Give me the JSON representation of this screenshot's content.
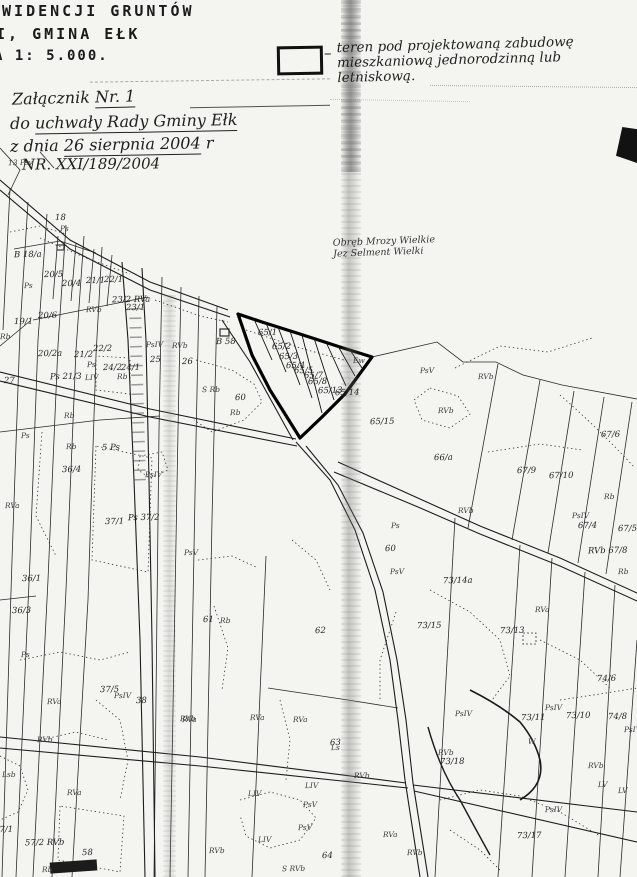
{
  "document": {
    "type": "scanned cadastral map attachment",
    "header": {
      "line1": "EWIDENCJI GRUNTÓW",
      "line2": "I, GMINA EŁK",
      "line3": "A 1: 5.000."
    },
    "handwritten": {
      "attachment_prefix": "Załącznik",
      "attachment_no": "Nr. 1",
      "resolution_prefix": "do",
      "resolution": "uchwały Rady Gminy Ełk",
      "date_prefix": "z dnia",
      "date": "26 sierpnia 2004",
      "date_suffix": "r",
      "number": "NR. XXI/189/2004"
    },
    "legend": {
      "symbol": "rectangle-outline",
      "dash": "–",
      "line1": "teren pod projektowaną zabudowę",
      "line2": "mieszkaniową jednorodzinną lub",
      "line3": "letniskową."
    }
  },
  "map": {
    "region_line1": "Obręb Mrozy Wielkie",
    "region_line2": "Jez Selment Wielki",
    "highlighted_parcels": [
      "65/1",
      "65/2",
      "65/3",
      "65/4",
      "65/5",
      "65/7",
      "65/8",
      "65/13",
      "65/14"
    ],
    "colors": {
      "ink": "#1c1c1c",
      "paper": "#f4f4f0",
      "highlight_stroke": "#000000"
    },
    "labels": [
      {
        "t": "13 Psv",
        "x": 8,
        "y": 158,
        "k": "cls"
      },
      {
        "t": "18",
        "x": 55,
        "y": 213,
        "k": "num"
      },
      {
        "t": "Ps",
        "x": 60,
        "y": 224,
        "k": "cls"
      },
      {
        "t": "B 18/a",
        "x": 14,
        "y": 250,
        "k": "num"
      },
      {
        "t": "Ps",
        "x": 24,
        "y": 281,
        "k": "cls"
      },
      {
        "t": "20/5",
        "x": 44,
        "y": 270,
        "k": "num"
      },
      {
        "t": "20/4",
        "x": 62,
        "y": 279,
        "k": "num"
      },
      {
        "t": "21/1",
        "x": 86,
        "y": 276,
        "k": "num"
      },
      {
        "t": "22/1",
        "x": 104,
        "y": 275,
        "k": "num"
      },
      {
        "t": "23/2 RVa",
        "x": 112,
        "y": 295,
        "k": "num"
      },
      {
        "t": "23/1",
        "x": 126,
        "y": 303,
        "k": "num"
      },
      {
        "t": "RVb",
        "x": 86,
        "y": 305,
        "k": "cls"
      },
      {
        "t": "20/6",
        "x": 38,
        "y": 311,
        "k": "num"
      },
      {
        "t": "19/1",
        "x": 14,
        "y": 317,
        "k": "num"
      },
      {
        "t": "Rb",
        "x": 0,
        "y": 332,
        "k": "cls"
      },
      {
        "t": "20/2a",
        "x": 38,
        "y": 349,
        "k": "num"
      },
      {
        "t": "21/2",
        "x": 74,
        "y": 350,
        "k": "num"
      },
      {
        "t": "22/2",
        "x": 93,
        "y": 344,
        "k": "num"
      },
      {
        "t": "Ps",
        "x": 87,
        "y": 360,
        "k": "cls"
      },
      {
        "t": "24/2",
        "x": 103,
        "y": 363,
        "k": "num"
      },
      {
        "t": "24/1",
        "x": 121,
        "y": 363,
        "k": "num"
      },
      {
        "t": "LIV",
        "x": 85,
        "y": 373,
        "k": "cls"
      },
      {
        "t": "Rb",
        "x": 117,
        "y": 372,
        "k": "cls"
      },
      {
        "t": "PsIV",
        "x": 146,
        "y": 340,
        "k": "cls"
      },
      {
        "t": "RVb",
        "x": 172,
        "y": 341,
        "k": "cls"
      },
      {
        "t": "25",
        "x": 150,
        "y": 355,
        "k": "num"
      },
      {
        "t": "26",
        "x": 182,
        "y": 357,
        "k": "num"
      },
      {
        "t": "27",
        "x": 4,
        "y": 376,
        "k": "num"
      },
      {
        "t": "Ps 21/3",
        "x": 50,
        "y": 372,
        "k": "num"
      },
      {
        "t": "Rb",
        "x": 64,
        "y": 411,
        "k": "cls"
      },
      {
        "t": "B 58",
        "x": 216,
        "y": 337,
        "k": "num"
      },
      {
        "t": "S Rb",
        "x": 202,
        "y": 385,
        "k": "cls"
      },
      {
        "t": "60",
        "x": 235,
        "y": 393,
        "k": "num"
      },
      {
        "t": "Rb",
        "x": 230,
        "y": 408,
        "k": "cls"
      },
      {
        "t": "65/1",
        "x": 258,
        "y": 328,
        "k": "num"
      },
      {
        "t": "65/2",
        "x": 272,
        "y": 342,
        "k": "num"
      },
      {
        "t": "65/3",
        "x": 279,
        "y": 352,
        "k": "num"
      },
      {
        "t": "65/4",
        "x": 286,
        "y": 361,
        "k": "num"
      },
      {
        "t": "65/5",
        "x": 294,
        "y": 366,
        "k": "num"
      },
      {
        "t": "65/7",
        "x": 304,
        "y": 371,
        "k": "num"
      },
      {
        "t": "65/8",
        "x": 308,
        "y": 377,
        "k": "num"
      },
      {
        "t": "65/13",
        "x": 318,
        "y": 386,
        "k": "num"
      },
      {
        "t": "65/14",
        "x": 335,
        "y": 388,
        "k": "num"
      },
      {
        "t": "Ew",
        "x": 353,
        "y": 356,
        "k": "cls"
      },
      {
        "t": "PsV",
        "x": 420,
        "y": 366,
        "k": "cls"
      },
      {
        "t": "RVb",
        "x": 478,
        "y": 372,
        "k": "cls"
      },
      {
        "t": "RVb",
        "x": 438,
        "y": 406,
        "k": "cls"
      },
      {
        "t": "65/15",
        "x": 370,
        "y": 417,
        "k": "num"
      },
      {
        "t": "66/a",
        "x": 434,
        "y": 453,
        "k": "num"
      },
      {
        "t": "67/9",
        "x": 517,
        "y": 466,
        "k": "num"
      },
      {
        "t": "67/10",
        "x": 549,
        "y": 471,
        "k": "num"
      },
      {
        "t": "67/6",
        "x": 601,
        "y": 430,
        "k": "num"
      },
      {
        "t": "Rb",
        "x": 604,
        "y": 492,
        "k": "cls"
      },
      {
        "t": "PsIV",
        "x": 572,
        "y": 511,
        "k": "cls"
      },
      {
        "t": "67/4",
        "x": 578,
        "y": 521,
        "k": "num"
      },
      {
        "t": "67/5",
        "x": 618,
        "y": 524,
        "k": "num"
      },
      {
        "t": "RVb 67/8",
        "x": 588,
        "y": 546,
        "k": "num"
      },
      {
        "t": "Rb",
        "x": 618,
        "y": 567,
        "k": "cls"
      },
      {
        "t": "RVb",
        "x": 458,
        "y": 506,
        "k": "cls"
      },
      {
        "t": "Ps",
        "x": 391,
        "y": 521,
        "k": "cls"
      },
      {
        "t": "60",
        "x": 385,
        "y": 544,
        "k": "num"
      },
      {
        "t": "PsV",
        "x": 390,
        "y": 567,
        "k": "cls"
      },
      {
        "t": "73/14a",
        "x": 443,
        "y": 576,
        "k": "num"
      },
      {
        "t": "RVa",
        "x": 535,
        "y": 605,
        "k": "cls"
      },
      {
        "t": "73/13",
        "x": 500,
        "y": 626,
        "k": "num"
      },
      {
        "t": "74/6",
        "x": 597,
        "y": 674,
        "k": "num"
      },
      {
        "t": "73/11",
        "x": 521,
        "y": 713,
        "k": "num"
      },
      {
        "t": "PsIV",
        "x": 545,
        "y": 703,
        "k": "cls"
      },
      {
        "t": "73/10",
        "x": 566,
        "y": 711,
        "k": "num"
      },
      {
        "t": "74/8",
        "x": 608,
        "y": 712,
        "k": "num"
      },
      {
        "t": "PsIV",
        "x": 624,
        "y": 725,
        "k": "cls"
      },
      {
        "t": "PsIV",
        "x": 455,
        "y": 709,
        "k": "cls"
      },
      {
        "t": "W",
        "x": 528,
        "y": 737,
        "k": "cls"
      },
      {
        "t": "RVb",
        "x": 438,
        "y": 748,
        "k": "cls"
      },
      {
        "t": "73/18",
        "x": 440,
        "y": 757,
        "k": "num"
      },
      {
        "t": "RVb",
        "x": 588,
        "y": 761,
        "k": "cls"
      },
      {
        "t": "LV",
        "x": 598,
        "y": 780,
        "k": "cls"
      },
      {
        "t": "LV",
        "x": 618,
        "y": 786,
        "k": "cls"
      },
      {
        "t": "PsIV",
        "x": 545,
        "y": 805,
        "k": "cls"
      },
      {
        "t": "73/17",
        "x": 517,
        "y": 831,
        "k": "num"
      },
      {
        "t": "73/15",
        "x": 417,
        "y": 621,
        "k": "num"
      },
      {
        "t": "61",
        "x": 203,
        "y": 615,
        "k": "num"
      },
      {
        "t": "Rb",
        "x": 220,
        "y": 616,
        "k": "cls"
      },
      {
        "t": "62",
        "x": 315,
        "y": 626,
        "k": "num"
      },
      {
        "t": "RVa",
        "x": 182,
        "y": 715,
        "k": "cls"
      },
      {
        "t": "RVa",
        "x": 250,
        "y": 713,
        "k": "cls"
      },
      {
        "t": "RVa",
        "x": 293,
        "y": 715,
        "k": "cls"
      },
      {
        "t": "63",
        "x": 330,
        "y": 738,
        "k": "num"
      },
      {
        "t": "RVb",
        "x": 354,
        "y": 771,
        "k": "cls"
      },
      {
        "t": "Ls",
        "x": 331,
        "y": 743,
        "k": "cls"
      },
      {
        "t": "LIV",
        "x": 305,
        "y": 781,
        "k": "cls"
      },
      {
        "t": "LIV",
        "x": 248,
        "y": 789,
        "k": "cls"
      },
      {
        "t": "PsV",
        "x": 303,
        "y": 800,
        "k": "cls"
      },
      {
        "t": "PsV",
        "x": 298,
        "y": 823,
        "k": "cls"
      },
      {
        "t": "LIV",
        "x": 258,
        "y": 835,
        "k": "cls"
      },
      {
        "t": "RVb",
        "x": 209,
        "y": 846,
        "k": "cls"
      },
      {
        "t": "64",
        "x": 322,
        "y": 851,
        "k": "num"
      },
      {
        "t": "S RVb",
        "x": 282,
        "y": 864,
        "k": "cls"
      },
      {
        "t": "RVa",
        "x": 383,
        "y": 830,
        "k": "cls"
      },
      {
        "t": "RVb",
        "x": 407,
        "y": 848,
        "k": "cls"
      },
      {
        "t": "Ps",
        "x": 21,
        "y": 650,
        "k": "cls"
      },
      {
        "t": "RVa",
        "x": 47,
        "y": 697,
        "k": "cls"
      },
      {
        "t": "37/5",
        "x": 100,
        "y": 685,
        "k": "num"
      },
      {
        "t": "PsIV",
        "x": 114,
        "y": 691,
        "k": "cls"
      },
      {
        "t": "38",
        "x": 136,
        "y": 696,
        "k": "num"
      },
      {
        "t": "RVb",
        "x": 180,
        "y": 714,
        "k": "cls"
      },
      {
        "t": "RVb",
        "x": 37,
        "y": 735,
        "k": "cls"
      },
      {
        "t": "Lsb",
        "x": 2,
        "y": 770,
        "k": "cls"
      },
      {
        "t": "RVa",
        "x": 67,
        "y": 788,
        "k": "cls"
      },
      {
        "t": "37/1",
        "x": -6,
        "y": 825,
        "k": "num"
      },
      {
        "t": "57/2 RVb",
        "x": 25,
        "y": 838,
        "k": "num"
      },
      {
        "t": "58",
        "x": 82,
        "y": 848,
        "k": "num"
      },
      {
        "t": "Rb",
        "x": 42,
        "y": 865,
        "k": "cls"
      },
      {
        "t": "Ps",
        "x": 21,
        "y": 431,
        "k": "cls"
      },
      {
        "t": "Rb",
        "x": 66,
        "y": 442,
        "k": "cls"
      },
      {
        "t": "36/4",
        "x": 62,
        "y": 465,
        "k": "num"
      },
      {
        "t": "5 Ps",
        "x": 102,
        "y": 443,
        "k": "num"
      },
      {
        "t": "PsIV",
        "x": 145,
        "y": 470,
        "k": "cls"
      },
      {
        "t": "37/1",
        "x": 105,
        "y": 517,
        "k": "num"
      },
      {
        "t": "Ps 37/2",
        "x": 128,
        "y": 513,
        "k": "num"
      },
      {
        "t": "PsV",
        "x": 184,
        "y": 548,
        "k": "cls"
      },
      {
        "t": "36/1",
        "x": 22,
        "y": 574,
        "k": "num"
      },
      {
        "t": "RVa",
        "x": 5,
        "y": 501,
        "k": "cls"
      },
      {
        "t": "36/3",
        "x": 12,
        "y": 606,
        "k": "num"
      }
    ]
  }
}
